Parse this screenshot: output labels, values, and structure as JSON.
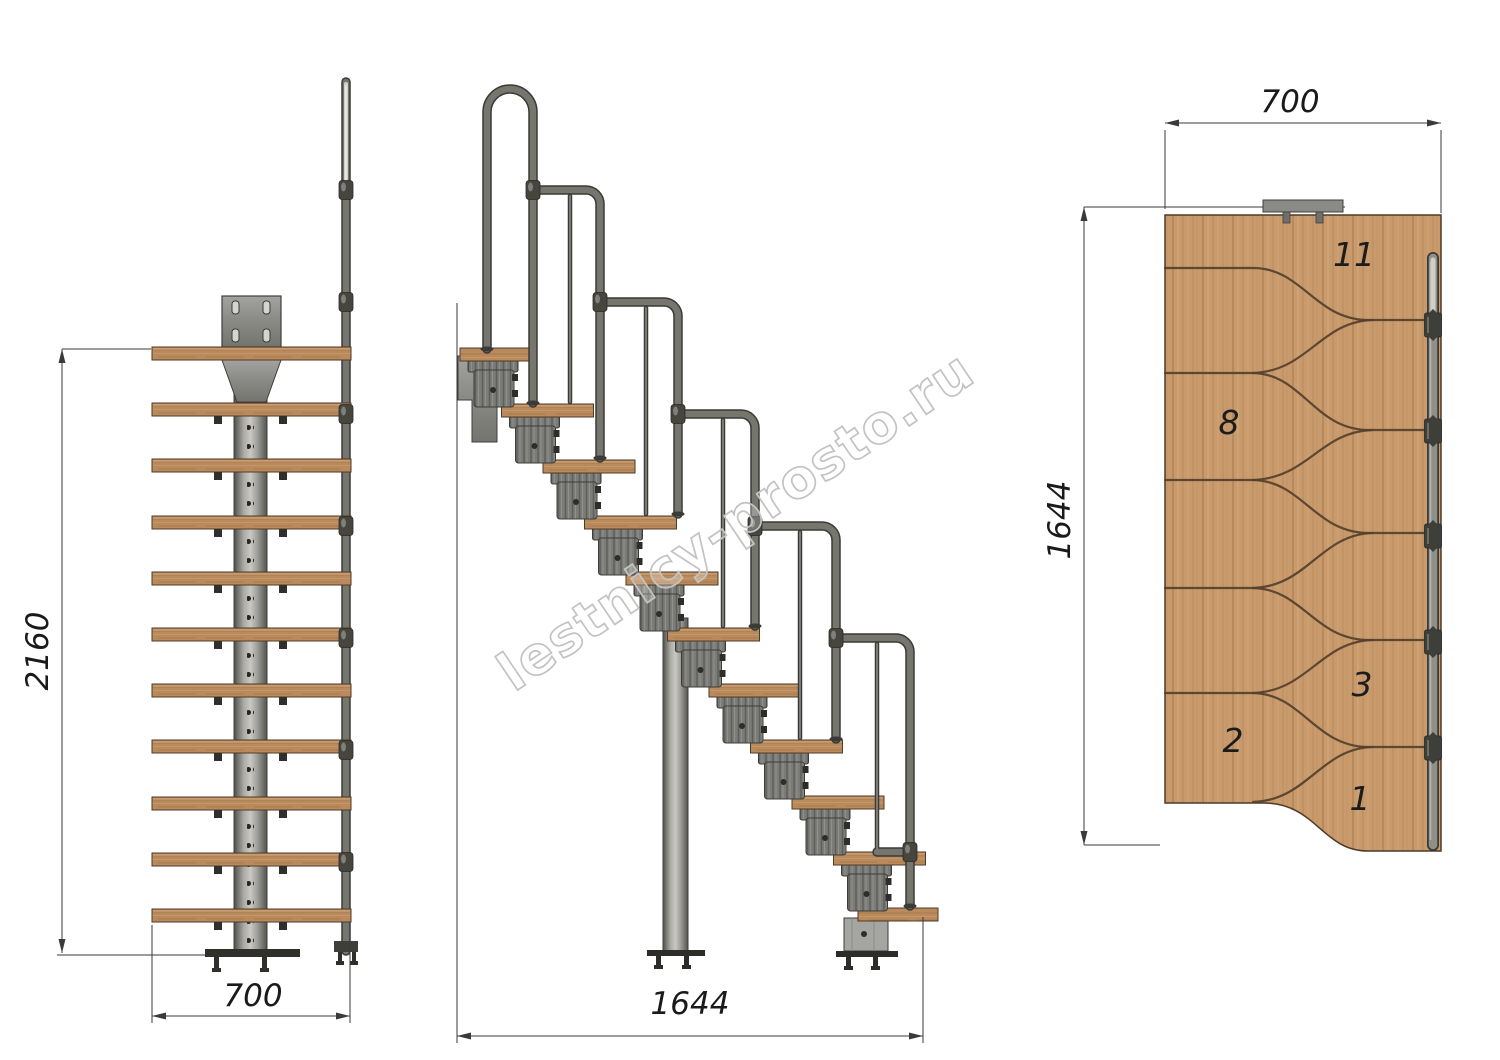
{
  "watermark": {
    "text": "lestnicy-prosto.ru"
  },
  "front_view": {
    "height_label": "2160",
    "width_label": "700"
  },
  "side_view": {
    "length_label": "1644"
  },
  "plan_view": {
    "width_label": "700",
    "length_label": "1644",
    "step_labels": [
      {
        "label": "11"
      },
      {
        "label": "8"
      },
      {
        "label": "3"
      },
      {
        "label": "2"
      },
      {
        "label": "1"
      }
    ]
  },
  "colors": {
    "background": "#ffffff",
    "wood": "#c89a6c",
    "wood_outline": "#4e3a28",
    "metal": "#76766f",
    "metal_dark": "#3a3a36",
    "dimension_line": "#3a3a3a",
    "watermark_outline": "#c3c3c3"
  }
}
